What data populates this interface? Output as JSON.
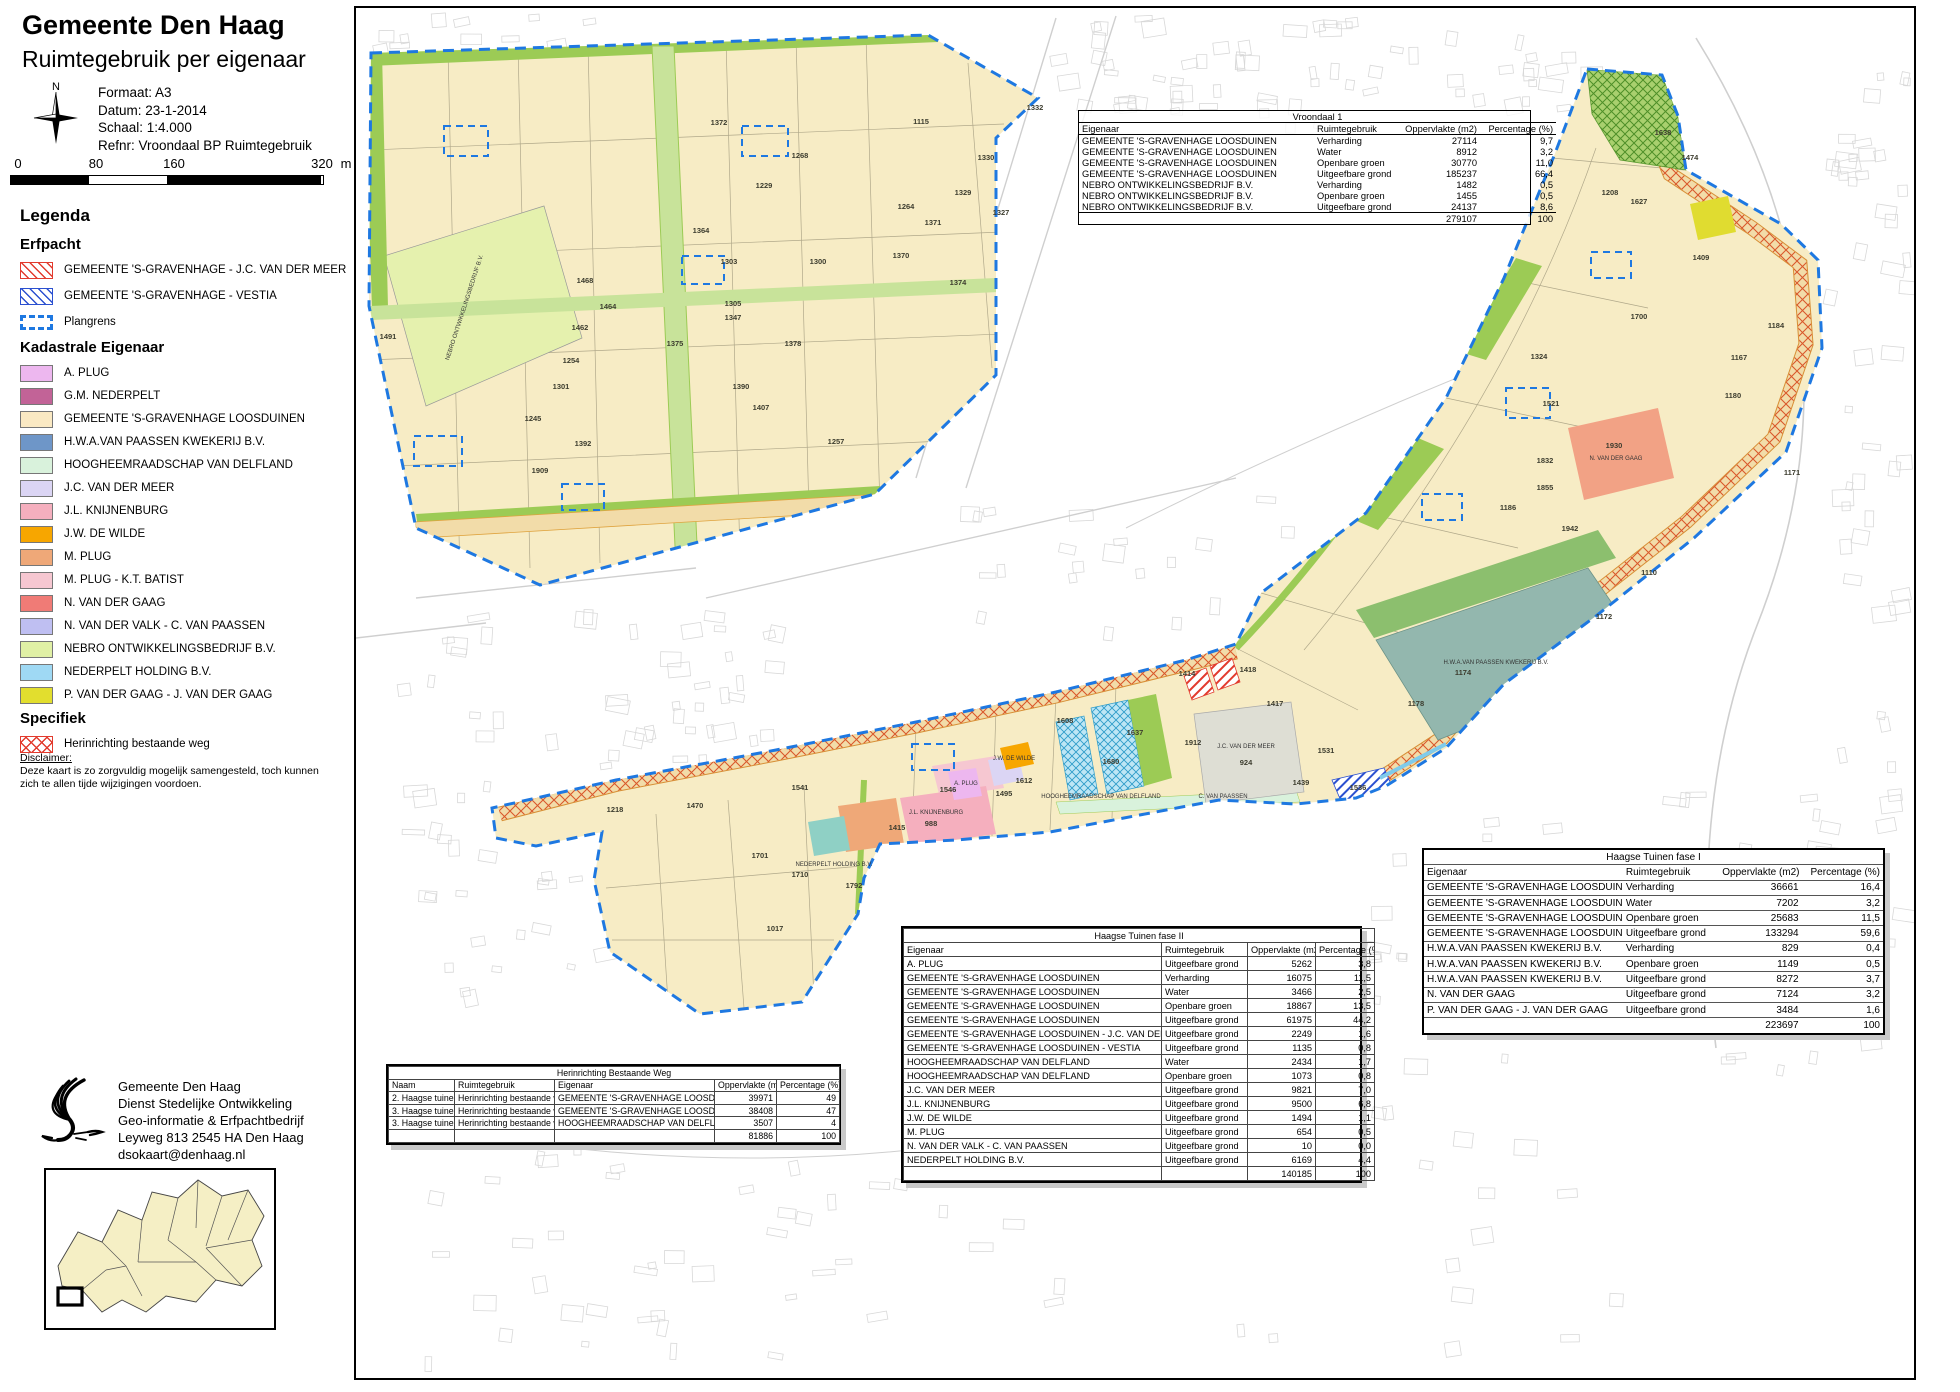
{
  "header": {
    "title": "Gemeente Den Haag",
    "subtitle": "Ruimtegebruik per eigenaar"
  },
  "meta": {
    "formaat": "Formaat: A3",
    "datum": "Datum: 23-1-2014",
    "schaal": "Schaal: 1:4.000",
    "refnr": "Refnr: Vroondaal BP Ruimtegebruik"
  },
  "compass": {
    "north_label": "N"
  },
  "scalebar": {
    "labels": [
      "0",
      "80",
      "160",
      "320"
    ],
    "unit": "m"
  },
  "legend": {
    "title": "Legenda",
    "sections": [
      {
        "heading": "Erfpacht",
        "kind": "erf",
        "items": [
          {
            "label": "GEMEENTE 'S-GRAVENHAGE - J.C. VAN DER MEER",
            "swatch": "hatch-red"
          },
          {
            "label": "GEMEENTE 'S-GRAVENHAGE - VESTIA",
            "swatch": "hatch-blue"
          },
          {
            "label": "Plangrens",
            "swatch": "dash-blue"
          }
        ]
      },
      {
        "heading": "Kadastrale Eigenaar",
        "kind": "kad",
        "items": [
          {
            "label": "A.  PLUG",
            "swatch": "solid",
            "color": "#edb7ef"
          },
          {
            "label": "G.M.  NEDERPELT",
            "swatch": "solid",
            "color": "#c26397"
          },
          {
            "label": "GEMEENTE 'S-GRAVENHAGE LOOSDUINEN",
            "swatch": "solid",
            "color": "#fae9c3"
          },
          {
            "label": "H.W.A.VAN PAASSEN KWEKERIJ B.V.",
            "swatch": "solid",
            "color": "#6e96c8"
          },
          {
            "label": "HOOGHEEMRAADSCHAP VAN DELFLAND",
            "swatch": "solid",
            "color": "#d9f2dc"
          },
          {
            "label": "J.C. VAN DER MEER",
            "swatch": "solid",
            "color": "#dbd5f4"
          },
          {
            "label": "J.L.  KNIJNENBURG",
            "swatch": "solid",
            "color": "#f5afbe"
          },
          {
            "label": "J.W. DE WILDE",
            "swatch": "solid",
            "color": "#f7a600"
          },
          {
            "label": "M.  PLUG",
            "swatch": "solid",
            "color": "#efa878"
          },
          {
            "label": "M.  PLUG - K.T. BATIST",
            "swatch": "solid",
            "color": "#f6c7d1"
          },
          {
            "label": "N. VAN DER GAAG",
            "swatch": "solid",
            "color": "#f07b76"
          },
          {
            "label": "N. VAN DER VALK - C. VAN PAASSEN",
            "swatch": "solid",
            "color": "#bfbff2"
          },
          {
            "label": "NEBRO ONTWIKKELINGSBEDRIJF B.V.",
            "swatch": "solid",
            "color": "#e0f0a5"
          },
          {
            "label": "NEDERPELT HOLDING B.V.",
            "swatch": "solid",
            "color": "#9fd9f4"
          },
          {
            "label": "P. VAN DER GAAG - J. VAN DER GAAG",
            "swatch": "solid",
            "color": "#e2de2e"
          }
        ]
      },
      {
        "heading": "Specifiek",
        "kind": "spec",
        "items": [
          {
            "label": "Herinrichting bestaande weg",
            "swatch": "cross-red"
          }
        ]
      }
    ]
  },
  "disclaimer": {
    "heading": "Disclaimer:",
    "text": "Deze kaart is zo zorgvuldig mogelijk samengesteld, toch kunnen zich te allen tijde wijzigingen voordoen."
  },
  "address": {
    "lines": [
      "Gemeente Den Haag",
      "Dienst Stedelijke Ontwikkeling",
      "Geo-informatie & Erfpachtbedrijf",
      "Leyweg 813  2545 HA Den Haag",
      "dsokaart@denhaag.nl"
    ]
  },
  "tables": [
    {
      "id": "vroondaal1",
      "el": "t-vroondaal",
      "title": "Vroondaal 1",
      "columns": [
        "Eigenaar",
        "Ruimtegebruik",
        "Oppervlakte (m2)",
        "Percentage (%)"
      ],
      "rows": [
        [
          "GEMEENTE 'S-GRAVENHAGE LOOSDUINEN",
          "Verharding",
          "27114",
          "9,7"
        ],
        [
          "GEMEENTE 'S-GRAVENHAGE LOOSDUINEN",
          "Water",
          "8912",
          "3,2"
        ],
        [
          "GEMEENTE 'S-GRAVENHAGE LOOSDUINEN",
          "Openbare groen",
          "30770",
          "11,0"
        ],
        [
          "GEMEENTE 'S-GRAVENHAGE LOOSDUINEN",
          "Uitgeefbare grond",
          "185237",
          "66,4"
        ],
        [
          "NEBRO ONTWIKKELINGSBEDRIJF B.V.",
          "Verharding",
          "1482",
          "0,5"
        ],
        [
          "NEBRO ONTWIKKELINGSBEDRIJF B.V.",
          "Openbare groen",
          "1455",
          "0,5"
        ],
        [
          "NEBRO ONTWIKKELINGSBEDRIJF B.V.",
          "Uitgeefbare grond",
          "24137",
          "8,6"
        ]
      ],
      "total": [
        "",
        "",
        "279107",
        "100"
      ]
    },
    {
      "id": "fase1",
      "el": "t-fase1",
      "title": "Haagse Tuinen fase I",
      "columns": [
        "Eigenaar",
        "Ruimtegebruik",
        "Oppervlakte (m2)",
        "Percentage (%)"
      ],
      "rows": [
        [
          "GEMEENTE 'S-GRAVENHAGE LOOSDUINEN",
          "Verharding",
          "36661",
          "16,4"
        ],
        [
          "GEMEENTE 'S-GRAVENHAGE LOOSDUINEN",
          "Water",
          "7202",
          "3,2"
        ],
        [
          "GEMEENTE 'S-GRAVENHAGE LOOSDUINEN",
          "Openbare groen",
          "25683",
          "11,5"
        ],
        [
          "GEMEENTE 'S-GRAVENHAGE LOOSDUINEN",
          "Uitgeefbare grond",
          "133294",
          "59,6"
        ],
        [
          "H.W.A.VAN PAASSEN KWEKERIJ B.V.",
          "Verharding",
          "829",
          "0,4"
        ],
        [
          "H.W.A.VAN PAASSEN KWEKERIJ B.V.",
          "Openbare groen",
          "1149",
          "0,5"
        ],
        [
          "H.W.A.VAN PAASSEN KWEKERIJ B.V.",
          "Uitgeefbare grond",
          "8272",
          "3,7"
        ],
        [
          "N. VAN DER GAAG",
          "Uitgeefbare grond",
          "7124",
          "3,2"
        ],
        [
          "P. VAN DER GAAG - J. VAN DER GAAG",
          "Uitgeefbare grond",
          "3484",
          "1,6"
        ]
      ],
      "total": [
        "",
        "",
        "223697",
        "100"
      ]
    },
    {
      "id": "fase2",
      "el": "t-fase2",
      "title": "Haagse Tuinen fase II",
      "columns": [
        "Eigenaar",
        "Ruimtegebruik",
        "Oppervlakte (m2)",
        "Percentage (%)"
      ],
      "rows": [
        [
          "A.  PLUG",
          "Uitgeefbare grond",
          "5262",
          "3,8"
        ],
        [
          "GEMEENTE 'S-GRAVENHAGE LOOSDUINEN",
          "Verharding",
          "16075",
          "11,5"
        ],
        [
          "GEMEENTE 'S-GRAVENHAGE LOOSDUINEN",
          "Water",
          "3466",
          "2,5"
        ],
        [
          "GEMEENTE 'S-GRAVENHAGE LOOSDUINEN",
          "Openbare groen",
          "18867",
          "13,5"
        ],
        [
          "GEMEENTE 'S-GRAVENHAGE LOOSDUINEN",
          "Uitgeefbare grond",
          "61975",
          "44,2"
        ],
        [
          "GEMEENTE 'S-GRAVENHAGE LOOSDUINEN - J.C. VAN DER MEER",
          "Uitgeefbare grond",
          "2249",
          "1,6"
        ],
        [
          "GEMEENTE 'S-GRAVENHAGE LOOSDUINEN - VESTIA",
          "Uitgeefbare grond",
          "1135",
          "0,8"
        ],
        [
          "HOOGHEEMRAADSCHAP VAN DELFLAND",
          "Water",
          "2434",
          "1,7"
        ],
        [
          "HOOGHEEMRAADSCHAP VAN DELFLAND",
          "Openbare groen",
          "1073",
          "0,8"
        ],
        [
          "J.C. VAN DER MEER",
          "Uitgeefbare grond",
          "9821",
          "7,0"
        ],
        [
          "J.L.  KNIJNENBURG",
          "Uitgeefbare grond",
          "9500",
          "6,8"
        ],
        [
          "J.W. DE WILDE",
          "Uitgeefbare grond",
          "1494",
          "1,1"
        ],
        [
          "M.  PLUG",
          "Uitgeefbare grond",
          "654",
          "0,5"
        ],
        [
          "N. VAN DER VALK - C. VAN PAASSEN",
          "Uitgeefbare grond",
          "10",
          "0,0"
        ],
        [
          "NEDERPELT HOLDING B.V.",
          "Uitgeefbare grond",
          "6169",
          "4,4"
        ]
      ],
      "total": [
        "",
        "",
        "140185",
        "100"
      ]
    },
    {
      "id": "herinr",
      "el": "t-herinr",
      "title": "Herinrichting Bestaande Weg",
      "columns": [
        "Naam",
        "Ruimtegebruik",
        "Eigenaar",
        "Oppervlakte (m2",
        "Percentage (%)"
      ],
      "rows": [
        [
          "2. Haagse tuinen",
          "Herinrichting bestaande weg",
          "GEMEENTE 'S-GRAVENHAGE LOOSDUINEN",
          "39971",
          "49"
        ],
        [
          "3. Haagse tuinen",
          "Herinrichting bestaande weg",
          "GEMEENTE 'S-GRAVENHAGE LOOSDUINEN",
          "38408",
          "47"
        ],
        [
          "3. Haagse tuinen",
          "Herinrichting bestaande weg",
          "HOOGHEEMRAADSCHAP VAN DELFLAND",
          "3507",
          "4"
        ]
      ],
      "total": [
        "",
        "",
        "",
        "81886",
        "100"
      ]
    }
  ],
  "map": {
    "plangrens_color": "#1e78e1",
    "parcel_labels": [
      {
        "t": "1372",
        "x": 363,
        "y": 117
      },
      {
        "t": "1115",
        "x": 565,
        "y": 116
      },
      {
        "t": "1332",
        "x": 679,
        "y": 102
      },
      {
        "t": "1330",
        "x": 630,
        "y": 152
      },
      {
        "t": "1329",
        "x": 607,
        "y": 187
      },
      {
        "t": "1327",
        "x": 645,
        "y": 207
      },
      {
        "t": "1371",
        "x": 577,
        "y": 217
      },
      {
        "t": "1370",
        "x": 545,
        "y": 250
      },
      {
        "t": "1374",
        "x": 602,
        "y": 277
      },
      {
        "t": "1268",
        "x": 444,
        "y": 150
      },
      {
        "t": "1264",
        "x": 550,
        "y": 201
      },
      {
        "t": "1229",
        "x": 408,
        "y": 180
      },
      {
        "t": "1364",
        "x": 345,
        "y": 225
      },
      {
        "t": "1303",
        "x": 373,
        "y": 256
      },
      {
        "t": "1300",
        "x": 462,
        "y": 256
      },
      {
        "t": "1305",
        "x": 377,
        "y": 298
      },
      {
        "t": "1468",
        "x": 229,
        "y": 275
      },
      {
        "t": "1464",
        "x": 252,
        "y": 301
      },
      {
        "t": "1462",
        "x": 224,
        "y": 322
      },
      {
        "t": "1347",
        "x": 377,
        "y": 312
      },
      {
        "t": "1375",
        "x": 319,
        "y": 338
      },
      {
        "t": "1378",
        "x": 437,
        "y": 338
      },
      {
        "t": "1491",
        "x": 32,
        "y": 331
      },
      {
        "t": "1254",
        "x": 215,
        "y": 355
      },
      {
        "t": "1301",
        "x": 205,
        "y": 381
      },
      {
        "t": "1245",
        "x": 177,
        "y": 413
      },
      {
        "t": "1392",
        "x": 227,
        "y": 438
      },
      {
        "t": "1909",
        "x": 184,
        "y": 465
      },
      {
        "t": "1390",
        "x": 385,
        "y": 381
      },
      {
        "t": "1407",
        "x": 405,
        "y": 402
      },
      {
        "t": "1257",
        "x": 480,
        "y": 436
      },
      {
        "t": "1638",
        "x": 1307,
        "y": 127
      },
      {
        "t": "1474",
        "x": 1334,
        "y": 152
      },
      {
        "t": "1627",
        "x": 1283,
        "y": 196
      },
      {
        "t": "1208",
        "x": 1254,
        "y": 187
      },
      {
        "t": "1409",
        "x": 1345,
        "y": 252
      },
      {
        "t": "1700",
        "x": 1283,
        "y": 311
      },
      {
        "t": "1324",
        "x": 1183,
        "y": 351
      },
      {
        "t": "1167",
        "x": 1383,
        "y": 352
      },
      {
        "t": "1180",
        "x": 1377,
        "y": 390
      },
      {
        "t": "1521",
        "x": 1195,
        "y": 398
      },
      {
        "t": "1832",
        "x": 1189,
        "y": 455
      },
      {
        "t": "1855",
        "x": 1189,
        "y": 482
      },
      {
        "t": "1930",
        "x": 1258,
        "y": 440
      },
      {
        "t": "1184",
        "x": 1420,
        "y": 320
      },
      {
        "t": "1171",
        "x": 1436,
        "y": 467
      },
      {
        "t": "1110",
        "x": 1293,
        "y": 567
      },
      {
        "t": "1942",
        "x": 1214,
        "y": 523
      },
      {
        "t": "1186",
        "x": 1152,
        "y": 502
      },
      {
        "t": "1172",
        "x": 1248,
        "y": 611
      },
      {
        "t": "1174",
        "x": 1107,
        "y": 667
      },
      {
        "t": "1178",
        "x": 1060,
        "y": 698
      },
      {
        "t": "1017",
        "x": 419,
        "y": 923
      },
      {
        "t": "1701",
        "x": 404,
        "y": 850
      },
      {
        "t": "1710",
        "x": 444,
        "y": 869
      },
      {
        "t": "1792",
        "x": 498,
        "y": 880
      },
      {
        "t": "1218",
        "x": 259,
        "y": 804
      },
      {
        "t": "1470",
        "x": 339,
        "y": 800
      },
      {
        "t": "1541",
        "x": 444,
        "y": 782
      },
      {
        "t": "1415",
        "x": 541,
        "y": 822
      },
      {
        "t": "988",
        "x": 575,
        "y": 818
      },
      {
        "t": "1546",
        "x": 592,
        "y": 784
      },
      {
        "t": "1495",
        "x": 648,
        "y": 788
      },
      {
        "t": "1612",
        "x": 668,
        "y": 775
      },
      {
        "t": "1608",
        "x": 709,
        "y": 715
      },
      {
        "t": "1637",
        "x": 779,
        "y": 727
      },
      {
        "t": "1680",
        "x": 755,
        "y": 756
      },
      {
        "t": "924",
        "x": 890,
        "y": 757
      },
      {
        "t": "1912",
        "x": 837,
        "y": 737
      },
      {
        "t": "1531",
        "x": 970,
        "y": 745
      },
      {
        "t": "1439",
        "x": 945,
        "y": 777
      },
      {
        "t": "1536",
        "x": 1002,
        "y": 782
      },
      {
        "t": "1417",
        "x": 919,
        "y": 698
      },
      {
        "t": "1418",
        "x": 892,
        "y": 664
      },
      {
        "t": "1414",
        "x": 831,
        "y": 668
      }
    ],
    "owner_labels": [
      {
        "t": "NEBRO ONTWIKKELINGSBEDRIJF B.V.",
        "x": 110,
        "y": 300,
        "r": -72
      },
      {
        "t": "J.C. VAN DER MEER",
        "x": 890,
        "y": 740
      },
      {
        "t": "C. VAN PAASSEN",
        "x": 867,
        "y": 790
      },
      {
        "t": "HOOGHEEMRAADSCHAP VAN DELFLAND",
        "x": 745,
        "y": 790
      },
      {
        "t": "N. VAN DER GAAG",
        "x": 1260,
        "y": 452
      },
      {
        "t": "H.W.A.VAN PAASSEN KWEKERIJ B.V.",
        "x": 1140,
        "y": 656
      },
      {
        "t": "J.L.  KNIJNENBURG",
        "x": 580,
        "y": 806
      },
      {
        "t": "A.  PLUG",
        "x": 610,
        "y": 777
      },
      {
        "t": "J.W. DE WILDE",
        "x": 658,
        "y": 752
      },
      {
        "t": "NEDERPELT HOLDING B.V.",
        "x": 478,
        "y": 858
      }
    ]
  }
}
